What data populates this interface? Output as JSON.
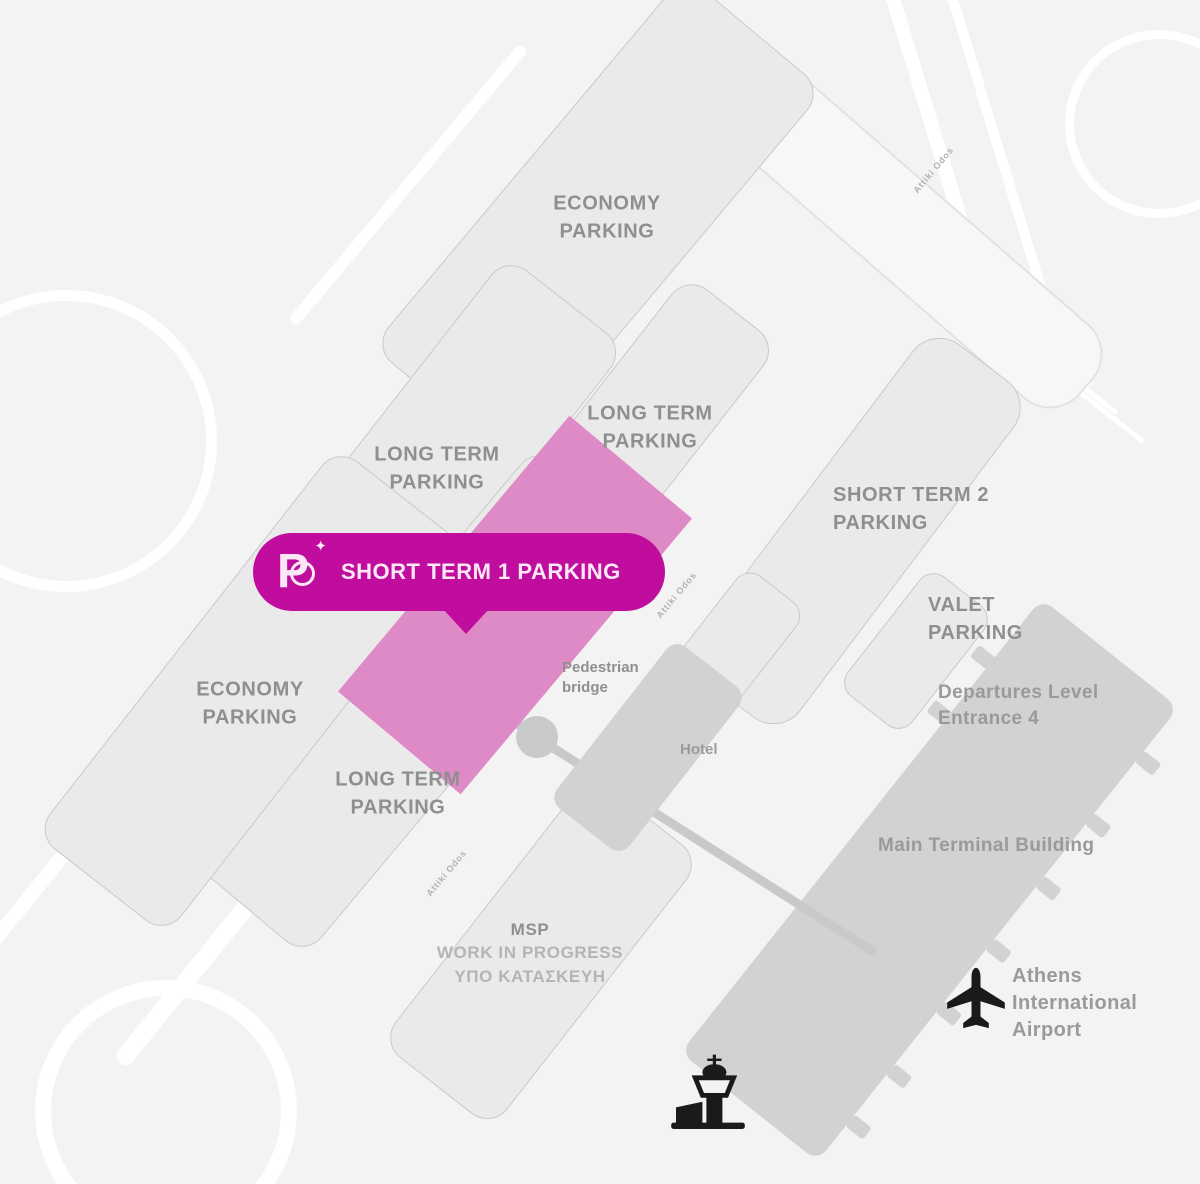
{
  "colors": {
    "background": "#f4f3f3",
    "lot_fill": "#ebeaea",
    "lot_border": "#c9c9c9",
    "building_fill": "#d2d2d2",
    "highlight_zone": "#de8ac6",
    "badge": "#c00d9e",
    "badge_text": "#fbe7f5",
    "label_text": "#8f8f8f",
    "muted_text": "#b4b4b4",
    "terminal_text": "#9a9a9a",
    "road_gray": "#c9c9c9",
    "icon": "#1a1a1a"
  },
  "badge": {
    "label": "SHORT TERM 1 PARKING",
    "logo_letter": "P",
    "logo_star": "✦"
  },
  "zones": {
    "economy_north": [
      "ECONOMY",
      "PARKING"
    ],
    "long_term_mid": [
      "LONG TERM",
      "PARKING"
    ],
    "long_term_upper": [
      "LONG TERM",
      "PARKING"
    ],
    "short_term_2": [
      "SHORT TERM 2",
      "PARKING"
    ],
    "valet": [
      "VALET",
      "PARKING"
    ],
    "economy_south": [
      "ECONOMY",
      "PARKING"
    ],
    "long_term_south": [
      "LONG TERM",
      "PARKING"
    ],
    "msp": [
      "MSP",
      "WORK IN PROGRESS",
      "ΥΠΟ ΚΑΤΑΣΚΕΥΗ"
    ]
  },
  "buildings": {
    "main_terminal": "Main Terminal Building",
    "departures": [
      "Departures Level",
      "Entrance 4"
    ],
    "hotel": "Hotel",
    "pedestrian_bridge": [
      "Pedestrian",
      "bridge"
    ]
  },
  "airport": {
    "name": [
      "Athens",
      "International",
      "Airport"
    ]
  },
  "roads": {
    "label": "Attiki Odos"
  }
}
